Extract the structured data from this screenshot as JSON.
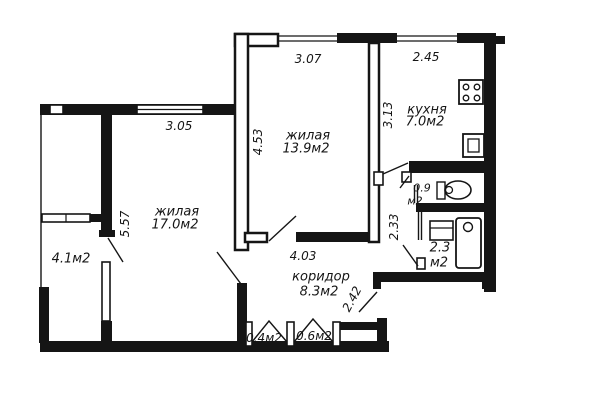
{
  "plan_title": "apartment floor plan",
  "colors": {
    "wall": "#151515",
    "background": "#ffffff"
  },
  "rooms": {
    "living_main": {
      "name": "жилая",
      "area": "17.0м2"
    },
    "living_second": {
      "name": "жилая",
      "area": "13.9м2"
    },
    "kitchen": {
      "name": "кухня",
      "area": "7.0м2"
    },
    "corridor": {
      "name": "коридор",
      "area": "8.3м2"
    },
    "loggia": {
      "area": "4.1м2"
    },
    "toilet": {
      "area": "0.9",
      "unit": "м2"
    },
    "bathroom": {
      "area": "2.3",
      "unit": "м2"
    },
    "closet_small": {
      "area": "0.4м2"
    },
    "closet_large": {
      "area": "0.6м2"
    }
  },
  "dimensions": {
    "room2_top": "3.07",
    "kitchen_top": "2.45",
    "kitchen_left": "3.13",
    "room2_left": "4.53",
    "room1_top": "3.05",
    "room1_left": "5.57",
    "san_block": "2.33",
    "corridor_width": "4.03",
    "corridor_height": "2.42"
  },
  "fixtures": {
    "stove": "stove-icon",
    "kitchen_sink": "kitchen-sink-icon",
    "toilet": "toilet-icon",
    "washbasin": "washbasin-icon",
    "bathtub": "bathtub-icon"
  }
}
